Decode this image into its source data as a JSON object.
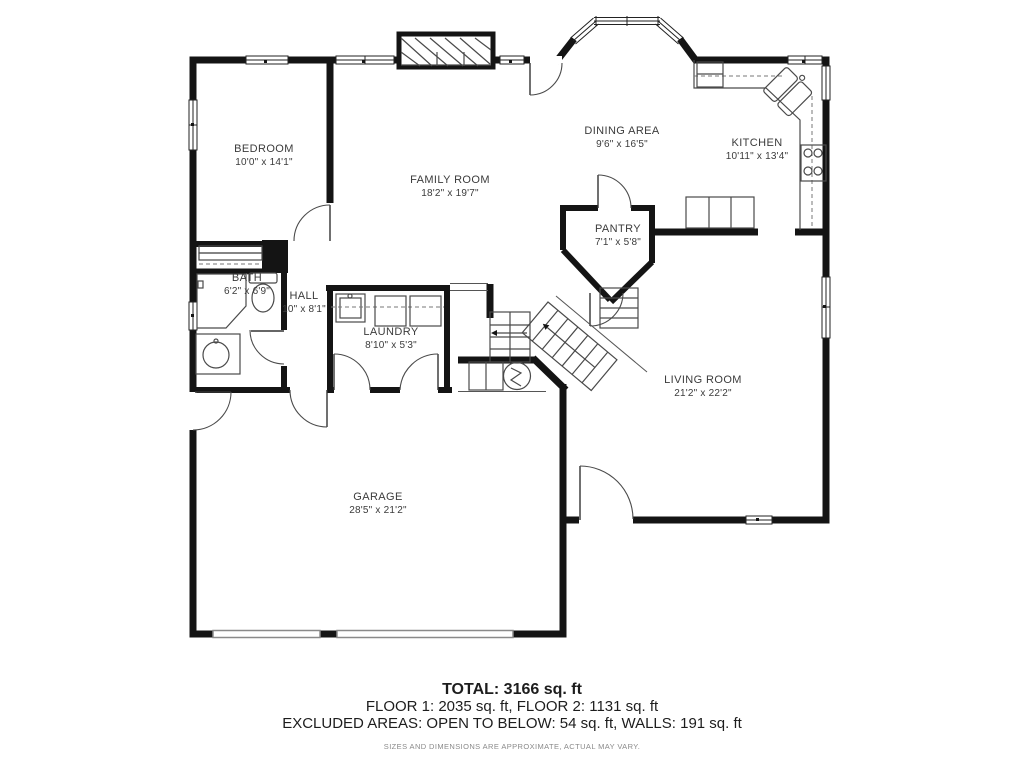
{
  "rooms": [
    {
      "id": "bedroom",
      "name": "BEDROOM",
      "dims": "10'0\" x 14'1\""
    },
    {
      "id": "family-room",
      "name": "FAMILY ROOM",
      "dims": "18'2\" x 19'7\""
    },
    {
      "id": "dining-area",
      "name": "DINING AREA",
      "dims": "9'6\" x 16'5\""
    },
    {
      "id": "kitchen",
      "name": "KITCHEN",
      "dims": "10'11\" x 13'4\""
    },
    {
      "id": "pantry",
      "name": "PANTRY",
      "dims": "7'1\" x 5'8\""
    },
    {
      "id": "hall",
      "name": "HALL",
      "dims": "10\" x 8'1\""
    },
    {
      "id": "bath",
      "name": "BATH",
      "dims": "6'2\" x 6'9\""
    },
    {
      "id": "laundry",
      "name": "LAUNDRY",
      "dims": "8'10\" x 5'3\""
    },
    {
      "id": "living-room",
      "name": "LIVING ROOM",
      "dims": "21'2\" x 22'2\""
    },
    {
      "id": "garage",
      "name": "GARAGE",
      "dims": "28'5\" x 21'2\""
    }
  ],
  "summary": {
    "total": "TOTAL: 3166 sq. ft",
    "floors": "FLOOR 1: 2035 sq. ft, FLOOR 2: 1131 sq. ft",
    "excluded": "EXCLUDED AREAS: OPEN TO BELOW: 54 sq. ft, WALLS: 191 sq. ft",
    "disclaimer": "SIZES AND DIMENSIONS ARE APPROXIMATE, ACTUAL MAY VARY."
  },
  "colors": {
    "wall": "#141414",
    "fixture": "#4a4a4a",
    "garage_door": "#8a8a8a",
    "label": "#3b3b3b",
    "disclaimer": "#8a8a8a"
  }
}
